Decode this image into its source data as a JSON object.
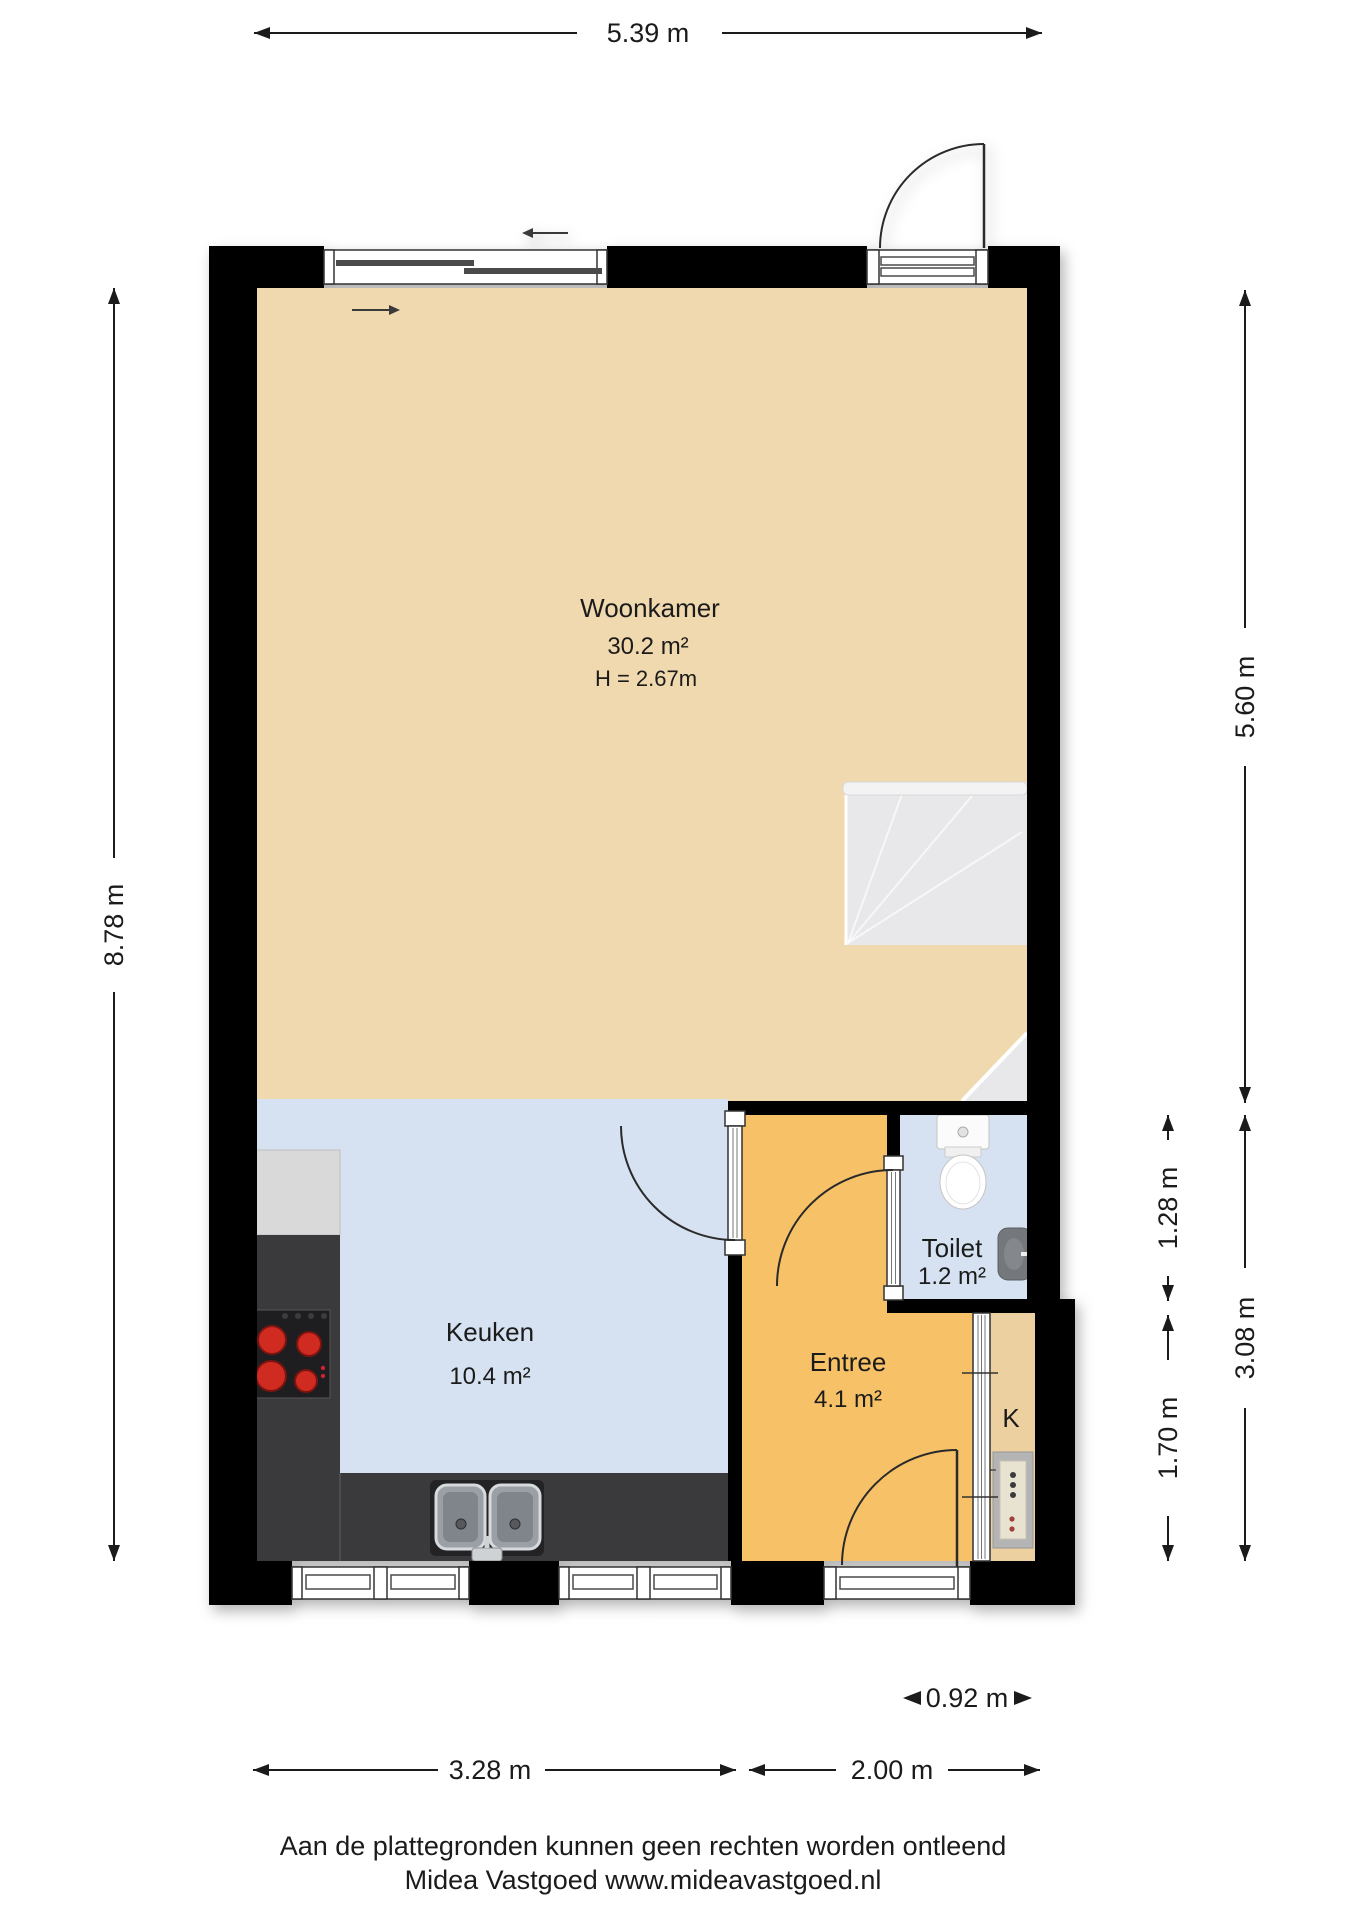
{
  "plan": {
    "rooms": {
      "woonkamer": {
        "name": "Woonkamer",
        "area": "30.2 m²",
        "ceiling_height": "H = 2.67m"
      },
      "keuken": {
        "name": "Keuken",
        "area": "10.4 m²"
      },
      "entree": {
        "name": "Entree",
        "area": "4.1 m²"
      },
      "toilet": {
        "name": "Toilet",
        "area": "1.2 m²"
      },
      "kast": {
        "name": "K"
      }
    },
    "dimensions": {
      "top_width": "5.39 m",
      "left_height": "8.78 m",
      "right_upper": "5.60 m",
      "right_lower_total": "3.08 m",
      "toilet_depth": "1.28 m",
      "kast_depth": "1.70 m",
      "bottom_keuken": "3.28 m",
      "bottom_entree": "2.00 m",
      "bottom_kast": "0.92 m"
    },
    "colors": {
      "wall": "#000000",
      "woonkamer_floor": "#f0d9ae",
      "keuken_floor": "#d6e2f1",
      "entree_floor": "#f7c167",
      "toilet_floor": "#d6e2f1",
      "kast_floor": "#ecd0a0",
      "stairs": "#e8e8ea",
      "stairs_lip": "#f3f3f4",
      "counter": "#3a3a3c",
      "cabinet": "#d9d9d9",
      "cooktop": "#1e1e20",
      "burner": "#cf2b20"
    }
  },
  "footer": {
    "line1": "Aan de plattegronden kunnen geen rechten worden ontleend",
    "line2": "Midea Vastgoed www.mideavastgoed.nl"
  }
}
